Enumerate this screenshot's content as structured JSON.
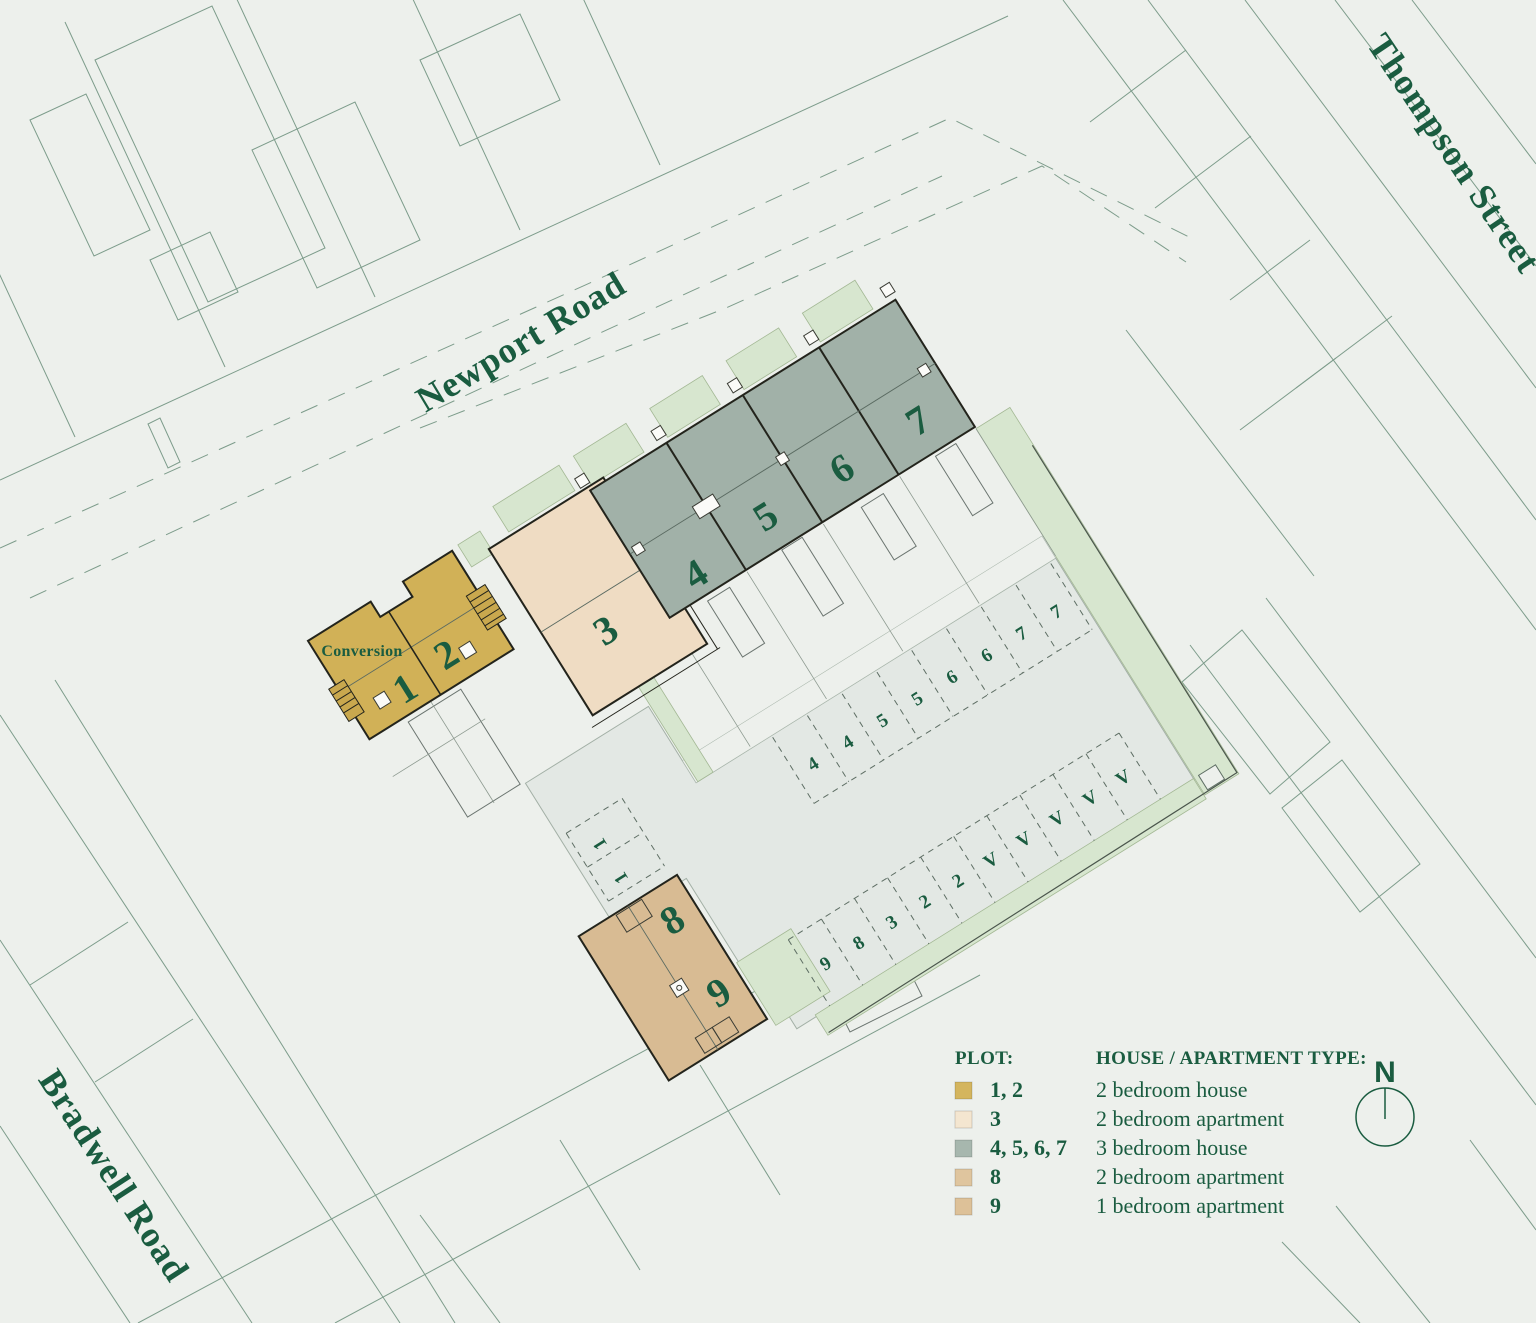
{
  "streets": {
    "newport_road": "Newport Road",
    "thompson_street": "Thompson Street",
    "bradwell_road": "Bradwell Road"
  },
  "site": {
    "conversion_label": "Conversion",
    "plot_numbers": [
      "1",
      "2",
      "3",
      "4",
      "5",
      "6",
      "7",
      "8",
      "9"
    ]
  },
  "parking": {
    "row_top": [
      "4",
      "4",
      "5",
      "5",
      "6",
      "6",
      "7",
      "7"
    ],
    "row_bottom": [
      "9",
      "8",
      "3",
      "2",
      "2",
      "V",
      "V",
      "V",
      "V",
      "V"
    ],
    "row_side": [
      "1",
      "1"
    ]
  },
  "compass": {
    "label": "N"
  },
  "legend": {
    "plot_header": "PLOT:",
    "type_header": "HOUSE / APARTMENT TYPE:",
    "rows": [
      {
        "plots": "1, 2",
        "type": "2 bedroom house",
        "color": "#d4b55e"
      },
      {
        "plots": "3",
        "type": "2 bedroom apartment",
        "color": "#f4e6d0"
      },
      {
        "plots": "4, 5, 6, 7",
        "type": "3 bedroom house",
        "color": "#a7b7ae"
      },
      {
        "plots": "8",
        "type": "2 bedroom apartment",
        "color": "#dfc59e"
      },
      {
        "plots": "9",
        "type": "1 bedroom apartment",
        "color": "#ddc198"
      }
    ]
  },
  "colors": {
    "background": "#edf0ec",
    "text_green": "#1a5c40",
    "context_line": "#7d9c8b",
    "paving": "#e3e8e4",
    "landscaping": "#d7e6cf",
    "plot_1_2": "#d1b157",
    "plot_3": "#efdcc3",
    "plot_4567": "#a1b1a8",
    "plot_8_9": "#d8bb93"
  }
}
